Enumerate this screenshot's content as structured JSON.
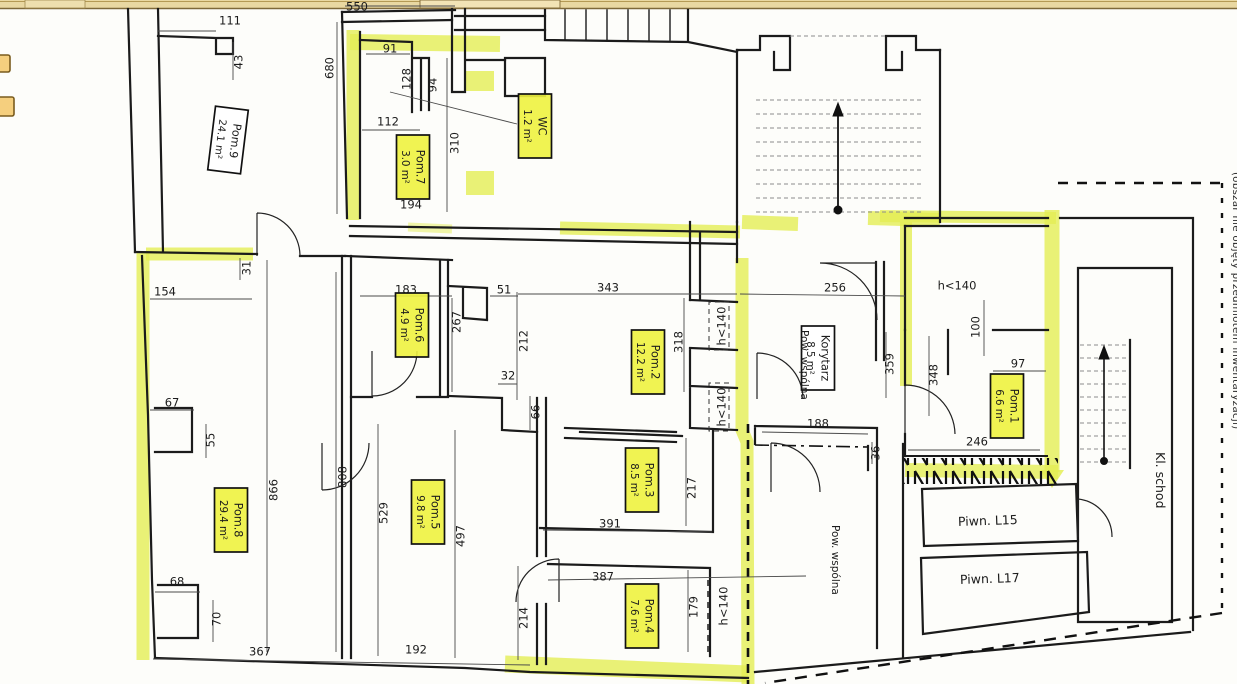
{
  "colors": {
    "highlight": "#e4ee55",
    "label_fill": "#eef23f",
    "wall": "#1b1b1b",
    "band_fill": "#e9d8a2",
    "band_line": "#7e693a",
    "marker_fill": "#f5cf7e",
    "marker_border": "#7a5c1e"
  },
  "chrome": {
    "top_band": "scanner-edge-band",
    "markers": [
      "page-marker",
      "page-marker"
    ]
  },
  "plan": {
    "room_labels": [
      {
        "name": "Pom.9",
        "area": "24.1 m²",
        "x": 228,
        "y": 140,
        "rot": 97,
        "fill": "white"
      },
      {
        "name": "Pom.7",
        "area": "3.0 m²",
        "x": 413,
        "y": 167,
        "rot": 90,
        "fill": "yellow"
      },
      {
        "name": "WC",
        "area": "1.2 m²",
        "x": 535,
        "y": 126,
        "rot": 90,
        "fill": "yellow"
      },
      {
        "name": "Pom.6",
        "area": "4.9 m²",
        "x": 412,
        "y": 325,
        "rot": 90,
        "fill": "yellow"
      },
      {
        "name": "Pom.2",
        "area": "12.2 m²",
        "x": 648,
        "y": 362,
        "rot": 90,
        "fill": "yellow"
      },
      {
        "name": "Korytarz",
        "area": "8.5 m²",
        "x": 818,
        "y": 358,
        "rot": 90,
        "fill": "white"
      },
      {
        "name": "Pom.1",
        "area": "6.6 m²",
        "x": 1007,
        "y": 406,
        "rot": 90,
        "fill": "yellow"
      },
      {
        "name": "Pom.3",
        "area": "8.5 m²",
        "x": 642,
        "y": 480,
        "rot": 90,
        "fill": "yellow"
      },
      {
        "name": "Pom.5",
        "area": "9.8 m²",
        "x": 428,
        "y": 512,
        "rot": 90,
        "fill": "yellow"
      },
      {
        "name": "Pom.8",
        "area": "29.4 m²",
        "x": 231,
        "y": 520,
        "rot": 90,
        "fill": "yellow"
      },
      {
        "name": "Pom.4",
        "area": "7.6 m²",
        "x": 642,
        "y": 616,
        "rot": 90,
        "fill": "yellow"
      }
    ],
    "dimensions": [
      {
        "t": "550",
        "x": 357,
        "y": 7,
        "r": 0
      },
      {
        "t": "111",
        "x": 230,
        "y": 21,
        "r": 0
      },
      {
        "t": "43",
        "x": 239,
        "y": 62,
        "r": -90
      },
      {
        "t": "680",
        "x": 330,
        "y": 68,
        "r": -90
      },
      {
        "t": "91",
        "x": 390,
        "y": 49,
        "r": 0
      },
      {
        "t": "128",
        "x": 407,
        "y": 79,
        "r": -90
      },
      {
        "t": "94",
        "x": 433,
        "y": 85,
        "r": -90
      },
      {
        "t": "112",
        "x": 388,
        "y": 122,
        "r": 0
      },
      {
        "t": "310",
        "x": 455,
        "y": 143,
        "r": -90
      },
      {
        "t": "194",
        "x": 411,
        "y": 205,
        "r": 0
      },
      {
        "t": "154",
        "x": 165,
        "y": 292,
        "r": 0
      },
      {
        "t": "31",
        "x": 247,
        "y": 268,
        "r": -90
      },
      {
        "t": "183",
        "x": 406,
        "y": 290,
        "r": 0
      },
      {
        "t": "51",
        "x": 504,
        "y": 290,
        "r": 0
      },
      {
        "t": "343",
        "x": 608,
        "y": 288,
        "r": 0
      },
      {
        "t": "267",
        "x": 457,
        "y": 322,
        "r": -90
      },
      {
        "t": "212",
        "x": 524,
        "y": 341,
        "r": -90
      },
      {
        "t": "32",
        "x": 508,
        "y": 376,
        "r": 0
      },
      {
        "t": "66",
        "x": 536,
        "y": 412,
        "r": -90
      },
      {
        "t": "318",
        "x": 679,
        "y": 342,
        "r": -90
      },
      {
        "t": "256",
        "x": 835,
        "y": 288,
        "r": 0
      },
      {
        "t": "h<140",
        "x": 957,
        "y": 286,
        "r": 0
      },
      {
        "t": "h<140",
        "x": 722,
        "y": 326,
        "r": -90,
        "box": 1
      },
      {
        "t": "h<140",
        "x": 722,
        "y": 407,
        "r": -90,
        "box": 1
      },
      {
        "t": "100",
        "x": 976,
        "y": 327,
        "r": -90
      },
      {
        "t": "359",
        "x": 890,
        "y": 364,
        "r": -90
      },
      {
        "t": "348",
        "x": 934,
        "y": 375,
        "r": -90
      },
      {
        "t": "97",
        "x": 1018,
        "y": 364,
        "r": 0
      },
      {
        "t": "188",
        "x": 818,
        "y": 424,
        "r": 0
      },
      {
        "t": "36",
        "x": 876,
        "y": 453,
        "r": -90
      },
      {
        "t": "246",
        "x": 977,
        "y": 442,
        "r": 0
      },
      {
        "t": "67",
        "x": 172,
        "y": 403,
        "r": 0
      },
      {
        "t": "55",
        "x": 211,
        "y": 440,
        "r": -90
      },
      {
        "t": "68",
        "x": 177,
        "y": 582,
        "r": 0
      },
      {
        "t": "70",
        "x": 217,
        "y": 619,
        "r": -90
      },
      {
        "t": "866",
        "x": 274,
        "y": 490,
        "r": -90
      },
      {
        "t": "808",
        "x": 343,
        "y": 477,
        "r": -90
      },
      {
        "t": "529",
        "x": 384,
        "y": 513,
        "r": -90
      },
      {
        "t": "497",
        "x": 461,
        "y": 536,
        "r": -90
      },
      {
        "t": "391",
        "x": 610,
        "y": 524,
        "r": 0
      },
      {
        "t": "217",
        "x": 692,
        "y": 488,
        "r": -90
      },
      {
        "t": "387",
        "x": 603,
        "y": 577,
        "r": 0
      },
      {
        "t": "179",
        "x": 694,
        "y": 607,
        "r": -90
      },
      {
        "t": "h<140",
        "x": 724,
        "y": 606,
        "r": -90
      },
      {
        "t": "214",
        "x": 524,
        "y": 618,
        "r": -90
      },
      {
        "t": "367",
        "x": 260,
        "y": 652,
        "r": 0
      },
      {
        "t": "192",
        "x": 416,
        "y": 650,
        "r": 0
      }
    ],
    "annotations": {
      "piwn_l15": "Piwn. L15",
      "piwn_l17": "Piwn. L17",
      "kl_schod": "Kl. schod",
      "pow_wspolna_1": "Pow. wspólna",
      "pow_wspolna_2": "Pow. wspólna",
      "boundary_note": "(obszar nie objęty przedmiotem inwentaryzacji)"
    }
  }
}
